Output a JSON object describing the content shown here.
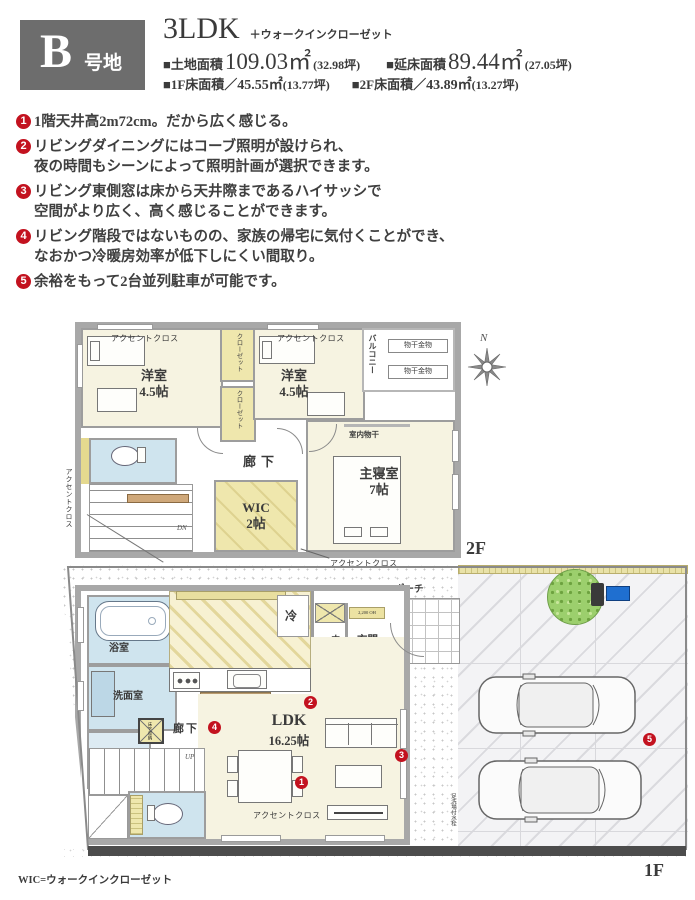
{
  "colors": {
    "accent_red": "#c3121f",
    "badge_gray": "#6d6d6d",
    "wall_gray": "#a8a8a8",
    "room_cream": "#f6f3e1",
    "closet_yellow": "#efe7ad",
    "wet_blue": "#cfe4ee",
    "counter_brown": "#b99a6e",
    "tree_green": "#9ccf6d",
    "mailbox_blue": "#1f6fd0"
  },
  "header": {
    "badge_letter": "B",
    "badge_suffix": "号地",
    "type": "3LDK",
    "type_suffix": "＋ウォークインクローゼット",
    "land": {
      "label": "■土地面積",
      "value": "109.03㎡",
      "tsubo": "(32.98坪)"
    },
    "total": {
      "label": "■延床面積",
      "value": "89.44㎡",
      "tsubo": "(27.05坪)"
    },
    "f1": {
      "label": "■1F床面積／",
      "value": "45.55㎡",
      "tsubo": "(13.77坪)"
    },
    "f2": {
      "label": "■2F床面積／",
      "value": "43.89㎡",
      "tsubo": "(13.27坪)"
    }
  },
  "features": [
    {
      "num": "1",
      "lines": [
        "1階天井高2m72cm。だから広く感じる。"
      ]
    },
    {
      "num": "2",
      "lines": [
        "リビングダイニングにはコーブ照明が設けられ、",
        "夜の時間もシーンによって照明計画が選択できます。"
      ]
    },
    {
      "num": "3",
      "lines": [
        "リビング東側窓は床から天井際まであるハイサッシで",
        "空間がより広く、高く感じることができます。"
      ]
    },
    {
      "num": "4",
      "lines": [
        "リビング階段ではないものの、家族の帰宅に気付くことができ、",
        "なおかつ冷暖房効率が低下しにくい間取り。"
      ]
    },
    {
      "num": "5",
      "lines": [
        "余裕をもって2台並列駐車が可能です。"
      ]
    }
  ],
  "plan2f": {
    "floor_label": "2F",
    "compass": "N",
    "accent": "アクセントクロス",
    "closet": "クローゼット",
    "balcony": "バルコニー",
    "monohoshi": "物干金物",
    "indoor_drying": "室内物干",
    "corridor": "廊下",
    "dn": "DN",
    "western_room": {
      "name": "洋室",
      "size": "4.5帖"
    },
    "wic": {
      "name": "WIC",
      "size": "2帖"
    },
    "master": {
      "name": "主寝室",
      "size": "7帖"
    }
  },
  "plan1f": {
    "floor_label": "1F",
    "accent": "アクセントクロス",
    "bath": "浴室",
    "washroom": "洗面室",
    "laundry": "洗",
    "underfloor": "床下収納",
    "corridor": "廊下",
    "refrigerator": "冷",
    "hall": "ホール",
    "entrance": "玄関",
    "entrance_note": "2,200 OH",
    "porch": "ポーチ",
    "ldk": {
      "name": "LDK",
      "size": "16.25帖"
    },
    "up": "UP",
    "foot_wash": "足洗場付水栓",
    "markers": [
      "1",
      "2",
      "3",
      "4",
      "5"
    ]
  },
  "footer": {
    "wic_note": "WIC=ウォークインクローゼット"
  }
}
